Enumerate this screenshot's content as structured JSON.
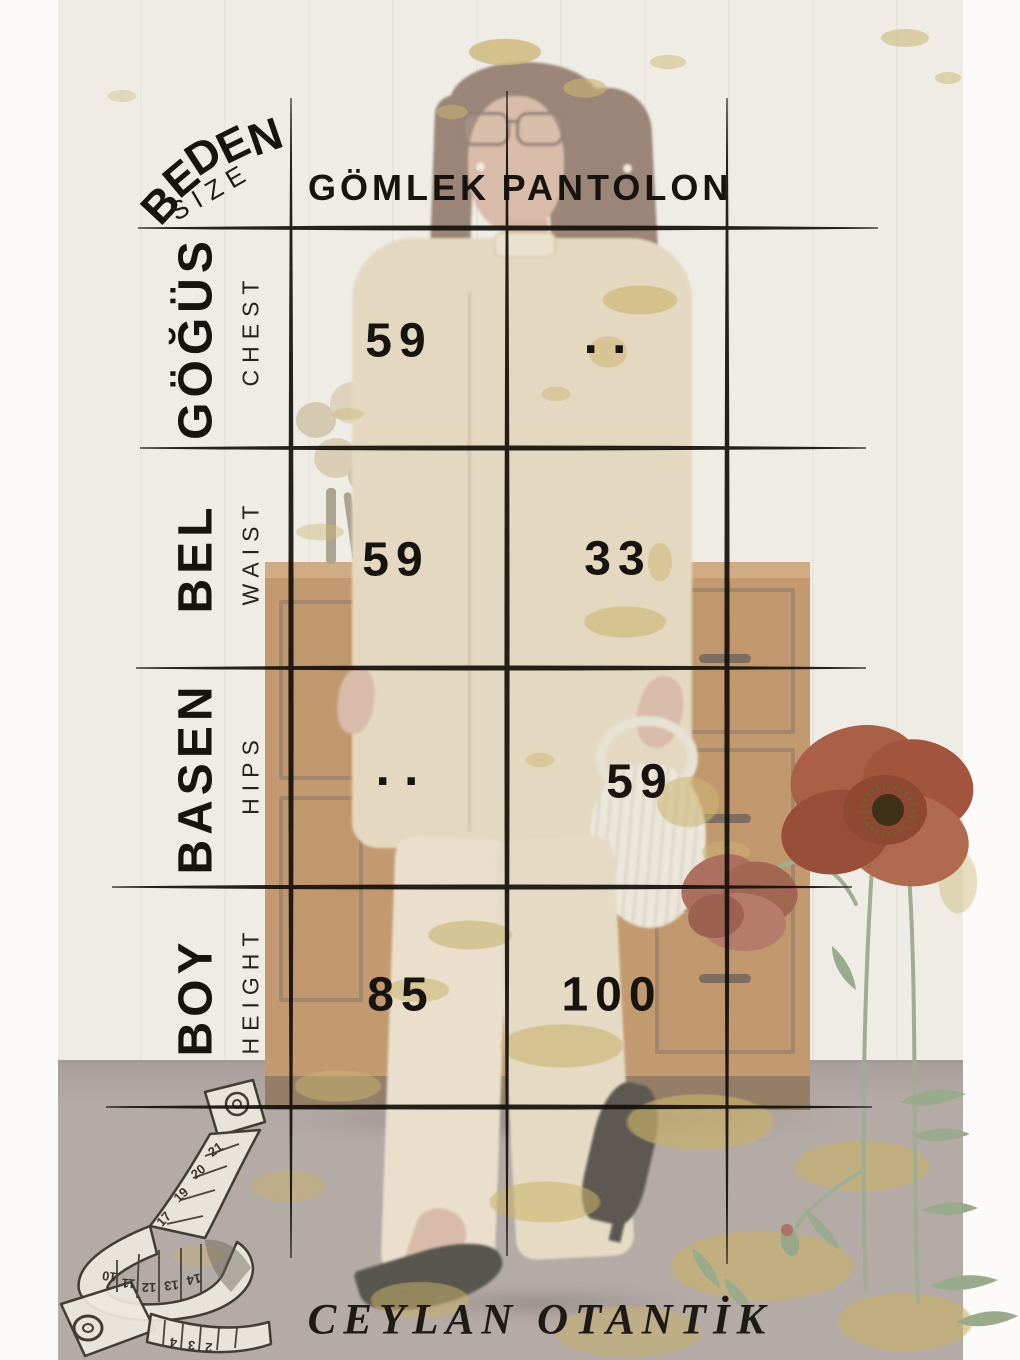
{
  "brand": {
    "label": "CEYLAN OTANTİK"
  },
  "size_table": {
    "corner": {
      "label": "BEDEN",
      "sublabel": "SIZE"
    },
    "columns": [
      "GÖMLEK",
      "PANTOLON"
    ],
    "rows": [
      {
        "label": "GÖĞÜS",
        "sublabel": "CHEST",
        "values": [
          "59",
          ".."
        ]
      },
      {
        "label": "BEL",
        "sublabel": "WAIST",
        "values": [
          "59",
          "33"
        ]
      },
      {
        "label": "BASEN",
        "sublabel": "HIPS",
        "values": [
          "..",
          "59"
        ]
      },
      {
        "label": "BOY",
        "sublabel": "HEIGHT",
        "values": [
          "85",
          "100"
        ]
      }
    ]
  },
  "chart_data": {
    "type": "table",
    "title": "BEDEN / SIZE — garment measurement chart",
    "columns": [
      "BEDEN / SIZE",
      "GÖMLEK",
      "PANTOLON"
    ],
    "rows": [
      [
        "GÖĞÜS (CHEST)",
        "59",
        ".."
      ],
      [
        "BEL (WAIST)",
        "59",
        "33"
      ],
      [
        "BASEN (HIPS)",
        "..",
        "59"
      ],
      [
        "BOY (HEIGHT)",
        "85",
        "100"
      ]
    ]
  },
  "decor": {
    "tape_numbers_upper": [
      "17",
      "19",
      "20",
      "21"
    ],
    "tape_numbers_middle": [
      "10",
      "11",
      "12",
      "13",
      "14"
    ],
    "tape_numbers_lower": [
      "4",
      "3",
      "2"
    ],
    "colors": {
      "gold": "#cbb872",
      "poppy": "#a65a41",
      "stem": "#9fae93",
      "line": "#15110c"
    }
  }
}
